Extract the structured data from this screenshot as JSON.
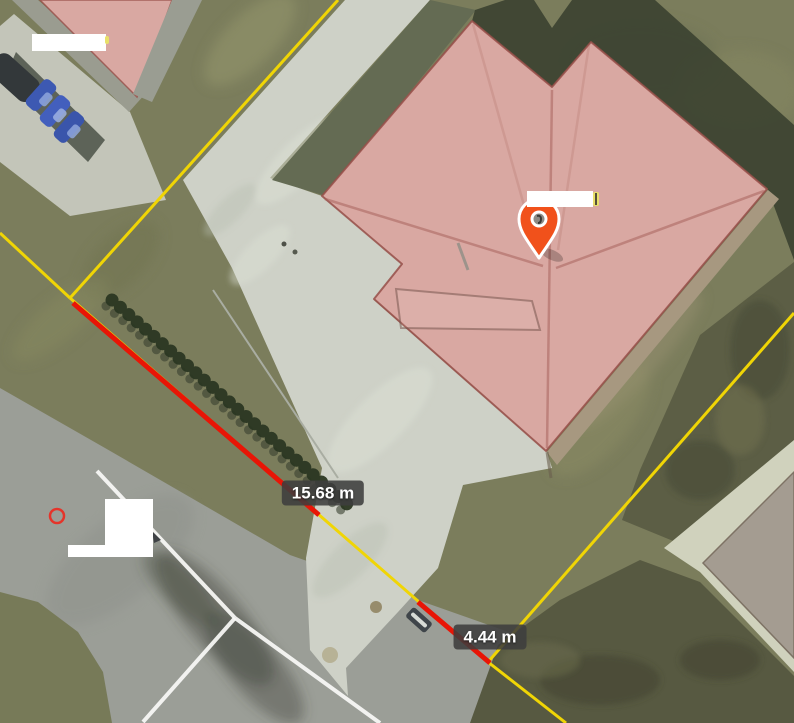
{
  "map": {
    "measurements": [
      {
        "id": "segment-1",
        "label": "15.68 m"
      },
      {
        "id": "segment-2",
        "label": "4.44 m"
      }
    ],
    "markers": {
      "pin": "location-pin-icon",
      "vertex": "vertex-circle-marker"
    },
    "overlays": {
      "redaction_count": 4
    }
  },
  "colors": {
    "boundary-yellow": "#f0d505",
    "measure-red": "#e81506",
    "pin-orange": "#f1511b",
    "roof-overlay": "#d9a8a2",
    "badge-bg": "rgba(62,62,62,0.88)",
    "badge-text": "#ffffff",
    "road-line-white": "#fafaf7",
    "vertex-red": "#e5342a",
    "redaction-white": "#ffffff"
  }
}
